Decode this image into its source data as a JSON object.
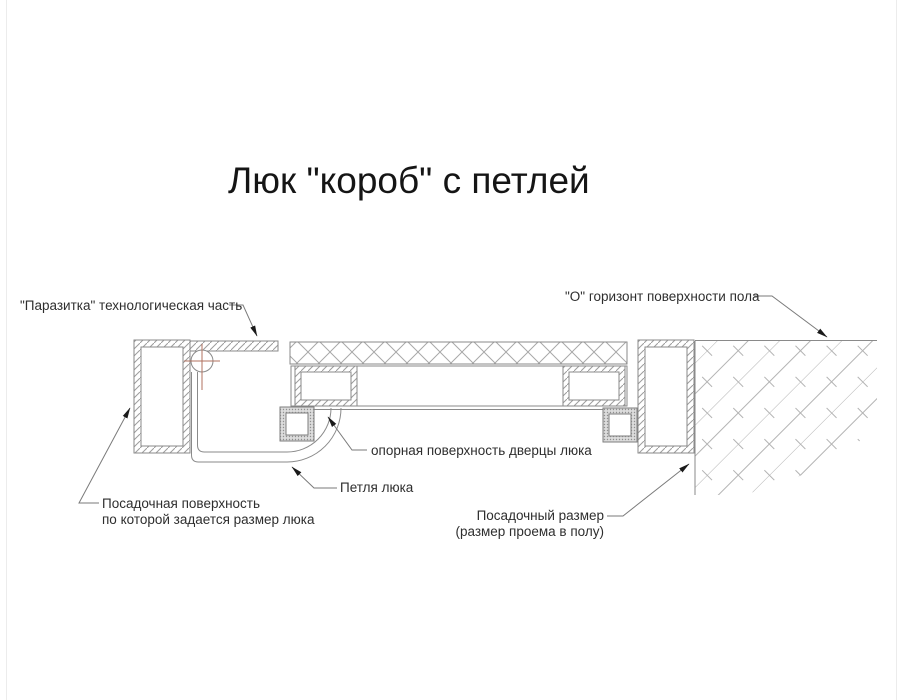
{
  "title": "Люк \"короб\" с петлей",
  "diagram": {
    "type": "technical-cross-section",
    "subject": "floor hatch box with hinge",
    "labels": {
      "parasitka": "\"Паразитка\" технологическая часть",
      "horizon": "\"О\" горизонт поверхности пола",
      "support_surface": "опорная поверхность дверцы люка",
      "hinge": "Петля люка",
      "seating_surface_line1": "Посадочная поверхность",
      "seating_surface_line2": "по которой задается размер люка",
      "seating_size_line1": "Посадочный размер",
      "seating_size_line2": "(размер проема в полу)"
    },
    "colors": {
      "background": "#ffffff",
      "drawing_line": "#8a8a8a",
      "hatch": "#a8a8a8",
      "floor_hatch": "#b3b3b3",
      "label_text": "#2e2e2e",
      "leader_line": "#7a7a7a",
      "arrowhead": "#1a1a1a",
      "hinge_axis_crosshair": "#b0715f",
      "tube_stipple": "#dcdcdc"
    }
  }
}
